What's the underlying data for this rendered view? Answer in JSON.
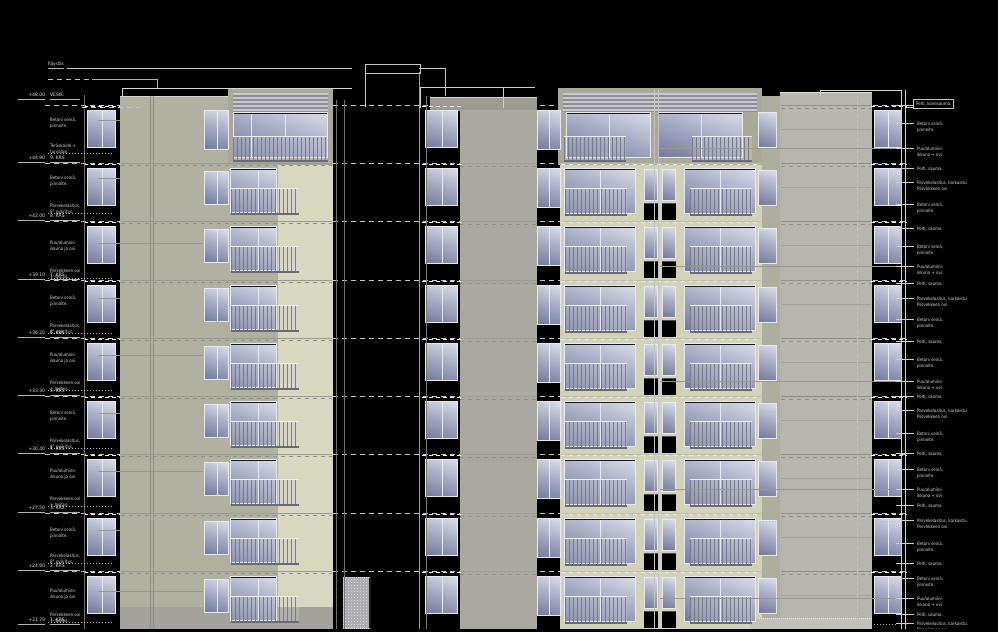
{
  "drawing": {
    "top_annotations": {
      "raystas": "Räystäs"
    },
    "elevation_markers": [
      {
        "y": 97,
        "level": "+48.00",
        "floor": "VESIK."
      },
      {
        "y": 160,
        "level": "+44.90",
        "floor": "9. KRS"
      },
      {
        "y": 218,
        "level": "+42.00",
        "floor": "8. KRS"
      },
      {
        "y": 277,
        "level": "+39.10",
        "floor": "7. KRS"
      },
      {
        "y": 335,
        "level": "+36.20",
        "floor": "6. KRS"
      },
      {
        "y": 393,
        "level": "+33.30",
        "floor": "5. KRS"
      },
      {
        "y": 451,
        "level": "+30.40",
        "floor": "4. KRS"
      },
      {
        "y": 510,
        "level": "+27.50",
        "floor": "3. KRS"
      },
      {
        "y": 568,
        "level": "+24.60",
        "floor": "2. KRS"
      },
      {
        "y": 622,
        "level": "+21.70",
        "floor": "1. KRS"
      }
    ],
    "left_label_types": {
      "betoni": [
        "Betoni seinä,",
        "pinnoite."
      ],
      "kaide": [
        "Teräskaide +",
        "turvalasi."
      ],
      "lasitus": [
        "Parvekelasitus,",
        "8° pyöritys."
      ],
      "ikkuna": [
        "Puu/alumiini-",
        "ikkuna ja ovi."
      ],
      "ovi": [
        "Parvekkeen ovi",
        "+ lasitus."
      ]
    },
    "left_labels": [
      {
        "y": 117,
        "type": "betoni"
      },
      {
        "y": 143,
        "type": "kaide"
      },
      {
        "y": 175,
        "type": "betoni"
      },
      {
        "y": 203,
        "type": "lasitus"
      },
      {
        "y": 240,
        "type": "ikkuna"
      },
      {
        "y": 268,
        "type": "ovi"
      },
      {
        "y": 295,
        "type": "betoni"
      },
      {
        "y": 323,
        "type": "lasitus"
      },
      {
        "y": 352,
        "type": "ikkuna"
      },
      {
        "y": 380,
        "type": "ovi"
      },
      {
        "y": 410,
        "type": "betoni"
      },
      {
        "y": 438,
        "type": "lasitus"
      },
      {
        "y": 468,
        "type": "ikkuna"
      },
      {
        "y": 496,
        "type": "ovi"
      },
      {
        "y": 527,
        "type": "betoni"
      },
      {
        "y": 553,
        "type": "lasitus"
      },
      {
        "y": 588,
        "type": "ikkuna"
      },
      {
        "y": 612,
        "type": "ovi"
      }
    ],
    "right_label_types": {
      "boxed": [
        "Pelti, konesauma."
      ],
      "betoni": [
        "Betoni seinä,",
        "pinnoite."
      ],
      "ikkuna": [
        "Puu/alumiini-",
        "ikkuna + ovi."
      ],
      "pelti": [
        "Pelti, sauma."
      ],
      "parveke": [
        "Parvekelasitus, karkaistu.",
        "Parvekkeen ovi."
      ]
    },
    "right_labels": [
      {
        "y": 103,
        "type": "boxed"
      },
      {
        "y": 121,
        "type": "betoni"
      },
      {
        "y": 146,
        "type": "ikkuna"
      },
      {
        "y": 166,
        "type": "pelti"
      },
      {
        "y": 180,
        "type": "parveke"
      },
      {
        "y": 202,
        "type": "betoni"
      },
      {
        "y": 226,
        "type": "pelti"
      },
      {
        "y": 244,
        "type": "betoni"
      },
      {
        "y": 264,
        "type": "ikkuna"
      },
      {
        "y": 281,
        "type": "pelti"
      },
      {
        "y": 296,
        "type": "parveke"
      },
      {
        "y": 317,
        "type": "betoni"
      },
      {
        "y": 339,
        "type": "pelti"
      },
      {
        "y": 357,
        "type": "betoni"
      },
      {
        "y": 379,
        "type": "ikkuna"
      },
      {
        "y": 394,
        "type": "pelti"
      },
      {
        "y": 408,
        "type": "parveke"
      },
      {
        "y": 431,
        "type": "betoni"
      },
      {
        "y": 451,
        "type": "pelti"
      },
      {
        "y": 467,
        "type": "betoni"
      },
      {
        "y": 487,
        "type": "ikkuna"
      },
      {
        "y": 503,
        "type": "pelti"
      },
      {
        "y": 518,
        "type": "parveke"
      },
      {
        "y": 541,
        "type": "betoni"
      },
      {
        "y": 561,
        "type": "pelti"
      },
      {
        "y": 576,
        "type": "betoni"
      },
      {
        "y": 596,
        "type": "ikkuna"
      },
      {
        "y": 612,
        "type": "pelti"
      },
      {
        "y": 621,
        "type": "parveke"
      }
    ],
    "building": {
      "type": "apartment-block-elevation",
      "levels": 10,
      "tower_floor_rows": 8,
      "window_column_rows": 9
    },
    "colors": {
      "background": "#000000",
      "facade_olive": "#b1b1a1",
      "facade_cream": "#d8d8c1",
      "central_tower_cream": "#d2d2ba",
      "penthouse_frame": "#a9a997",
      "mid_wing_gray": "#a9a9a1",
      "cap_gray": "#9b9b93",
      "right_facade_gray": "#b6b6ae",
      "glass_light": "#d9dce8",
      "glass_dark": "#747a9d",
      "level_dash_bright": "#c6c6c6",
      "level_dash_dark": "#8f8f87",
      "annotation_text": "#cfcfcf"
    }
  }
}
